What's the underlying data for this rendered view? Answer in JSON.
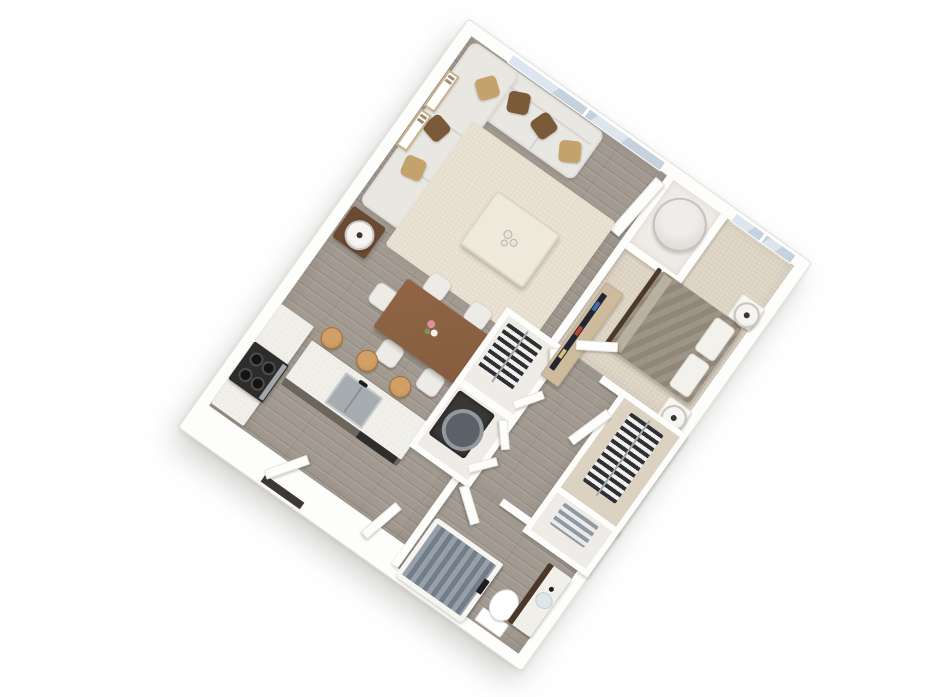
{
  "meta": {
    "kind": "3d-floor-plan-render",
    "view": "rotated-isometric",
    "unit_type": "one-bedroom-apartment",
    "background": "#ffffff",
    "rotation_deg": 35.4
  },
  "palette": {
    "wall": "#fdfdfc",
    "wallEdge": "#e3e1dc",
    "woodFloor": "#a29a90",
    "carpet": "#dcd2c2",
    "closetFloor": "#efece7",
    "rug": "#e9e2d3",
    "sofa": "#e9e7e2",
    "pillowBrown": "#7a5a38",
    "pillowTan": "#c4a26c",
    "coffeeTable": "#efe9db",
    "sideTable": "#6b4a33",
    "tableWood": "#855d3e",
    "chairWhite": "#edebe6",
    "stoolWood": "#c08a50",
    "counter": "#f1efe9",
    "islandBase": "#6b655c",
    "applianceBlack": "#2f2d2b",
    "stainless": "#a3a8ac",
    "sinkGray": "#a7acb0",
    "glass": "#c5d2dd",
    "glassLight": "#dde6ee",
    "duvet": "#988d80",
    "bedFrame": "#4d3a29",
    "pillowWhite": "#f3f1ec",
    "lampWhite": "#f6f5f2",
    "consoleWood": "#cdbb9c",
    "tvDark": "#202733",
    "clothesDark": "#303032",
    "clothesLight": "#efefef",
    "towelGray": "#8f99a2",
    "towelLight": "#e9e9e9",
    "curtainA": "#97a0aa",
    "curtainB": "#737d88",
    "fixtureBlack": "#1d1d1d",
    "vanityWood": "#4a3729",
    "sinkBowl": "#dfe7ec",
    "heaterGray": "#dedcd7",
    "washerDark": "#3a3836",
    "washerRing": "#92989e",
    "artTan": "#c9b089",
    "flowerPink": "#e08f9e",
    "flowerWhite": "#f5f2ee",
    "leafGreen": "#7d8f5a",
    "thresholdDark": "#3b3835"
  },
  "scene": {
    "rooms": [
      {
        "name": "living-room",
        "floor": "wood",
        "features": [
          "large-window-north",
          "wall-art-x2",
          "sectional-sofa",
          "area-rug",
          "coffee-table",
          "side-table-with-lamp"
        ]
      },
      {
        "name": "dining-area",
        "floor": "wood",
        "features": [
          "wood-dining-table",
          "six-white-chairs",
          "flower-centerpiece"
        ]
      },
      {
        "name": "kitchen",
        "floor": "wood",
        "features": [
          "west-counter-run",
          "black-range",
          "island-with-sink",
          "dishwasher",
          "three-bar-stools"
        ]
      },
      {
        "name": "bedroom",
        "floor": "carpet",
        "features": [
          "window-north",
          "bed-taupe-duvet",
          "two-nightstand-lamps",
          "tv-console",
          "wardrobe-closet"
        ]
      },
      {
        "name": "utility-closet",
        "floor": "plain",
        "features": [
          "water-heater"
        ]
      },
      {
        "name": "wardrobe-closet-hall",
        "floor": "plain",
        "features": [
          "hanging-clothes",
          "open-double-doors"
        ]
      },
      {
        "name": "laundry-closet",
        "floor": "plain",
        "features": [
          "washer-dryer",
          "open-double-doors"
        ]
      },
      {
        "name": "linen-closet",
        "floor": "plain",
        "features": [
          "stacked-towels"
        ]
      },
      {
        "name": "bathroom",
        "floor": "wood",
        "features": [
          "tub-with-striped-curtain",
          "black-shower-fixture",
          "toilet",
          "dark-wood-vanity-sink"
        ]
      },
      {
        "name": "entry",
        "floor": "wood",
        "features": [
          "entry-door-open",
          "dark-threshold"
        ]
      }
    ],
    "counts": {
      "dining_chairs": 6,
      "bar_stools": 3,
      "sofa_pillows": 6,
      "nightstands": 2,
      "windows": 2,
      "wall_art": 2
    }
  }
}
